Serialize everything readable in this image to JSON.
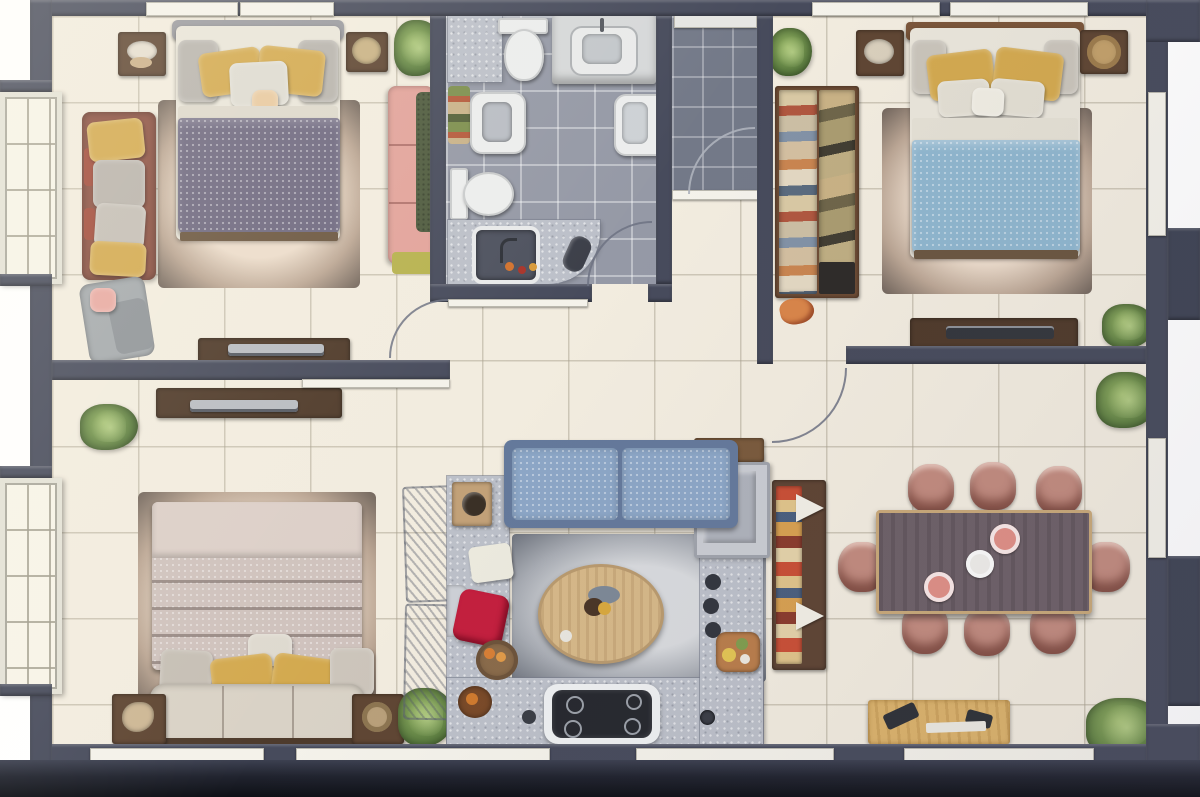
{
  "meta": {
    "title": "Top-down 3D rendered floor plan of a three-bedroom apartment",
    "view": "top-down orthographic render",
    "text_labels": []
  },
  "palette": {
    "wall": "#474b5c",
    "floor_cream": "#f2ecdf",
    "bath_tile": "#9599a6",
    "entry_tile": "#737988",
    "counter_gray": "#bcc0c9",
    "bed1_duvet": "#6e6880",
    "bed2_duvet": "#8fb6ce",
    "bed3_duvet": "#cfc2bd",
    "sofa_rust": "#8d5143",
    "sofa_pink": "#e2a39b",
    "sofa_blue": "#8ca6c6",
    "chair_pink": "#c28b7e",
    "dining_table": "#6d6067",
    "wood_dark": "#4f3a2a",
    "wood_mid": "#5f4633",
    "wood_light": "#dcb36b",
    "coffee_table": "#d6b888",
    "headboard_wood": "#7a5539",
    "pillow_yellow": "#d3a94f",
    "cushion_red": "#c31f3e",
    "fridge": "#c9ccd2",
    "cooktop": "#26282e",
    "sideboard": "#5e4433"
  },
  "rooms": [
    {
      "id": "bedroom-1",
      "label": "Bedroom 1 (top-left): double bed with purple duvet, rust sofa, pink sofa, lounge chair, two nightstands, TV console, rug, plant"
    },
    {
      "id": "bathroom",
      "label": "Bathroom (top-center): two toilets, vanity sink, wall sink, basin counter, curved shower counter, gray tile floor"
    },
    {
      "id": "entry-hall",
      "label": "Entry hall (top-center-right): dark tiled entry with door swing"
    },
    {
      "id": "bedroom-2",
      "label": "Bedroom 2 (top-right): double bed with blue duvet, open wardrobe with clothes, two nightstands, TV console, plants"
    },
    {
      "id": "bedroom-3",
      "label": "Bedroom 3 (bottom-left): double bed with striped duvet and bench footboard, two nightstands, TV console, plants"
    },
    {
      "id": "kitchen-living",
      "label": "Kitchen / living (bottom-center): U-shaped counter, cooktop, fridge, blue sofa, round coffee table, red cushion, fruit bowls, sketched chairs"
    },
    {
      "id": "dining-room",
      "label": "Dining room (bottom-right): eight-seat dark wood table, pink chairs, sideboard with colorful runner, light wood console, plants"
    }
  ],
  "counts": {
    "bedrooms": 3,
    "dining_chairs": 8,
    "toilets": 2,
    "sinks": 4,
    "door_swings": 4,
    "plants": 8,
    "windows_top": 4,
    "windows_bottom": 4,
    "bay_windows_left": 2,
    "windows_right": 2
  }
}
